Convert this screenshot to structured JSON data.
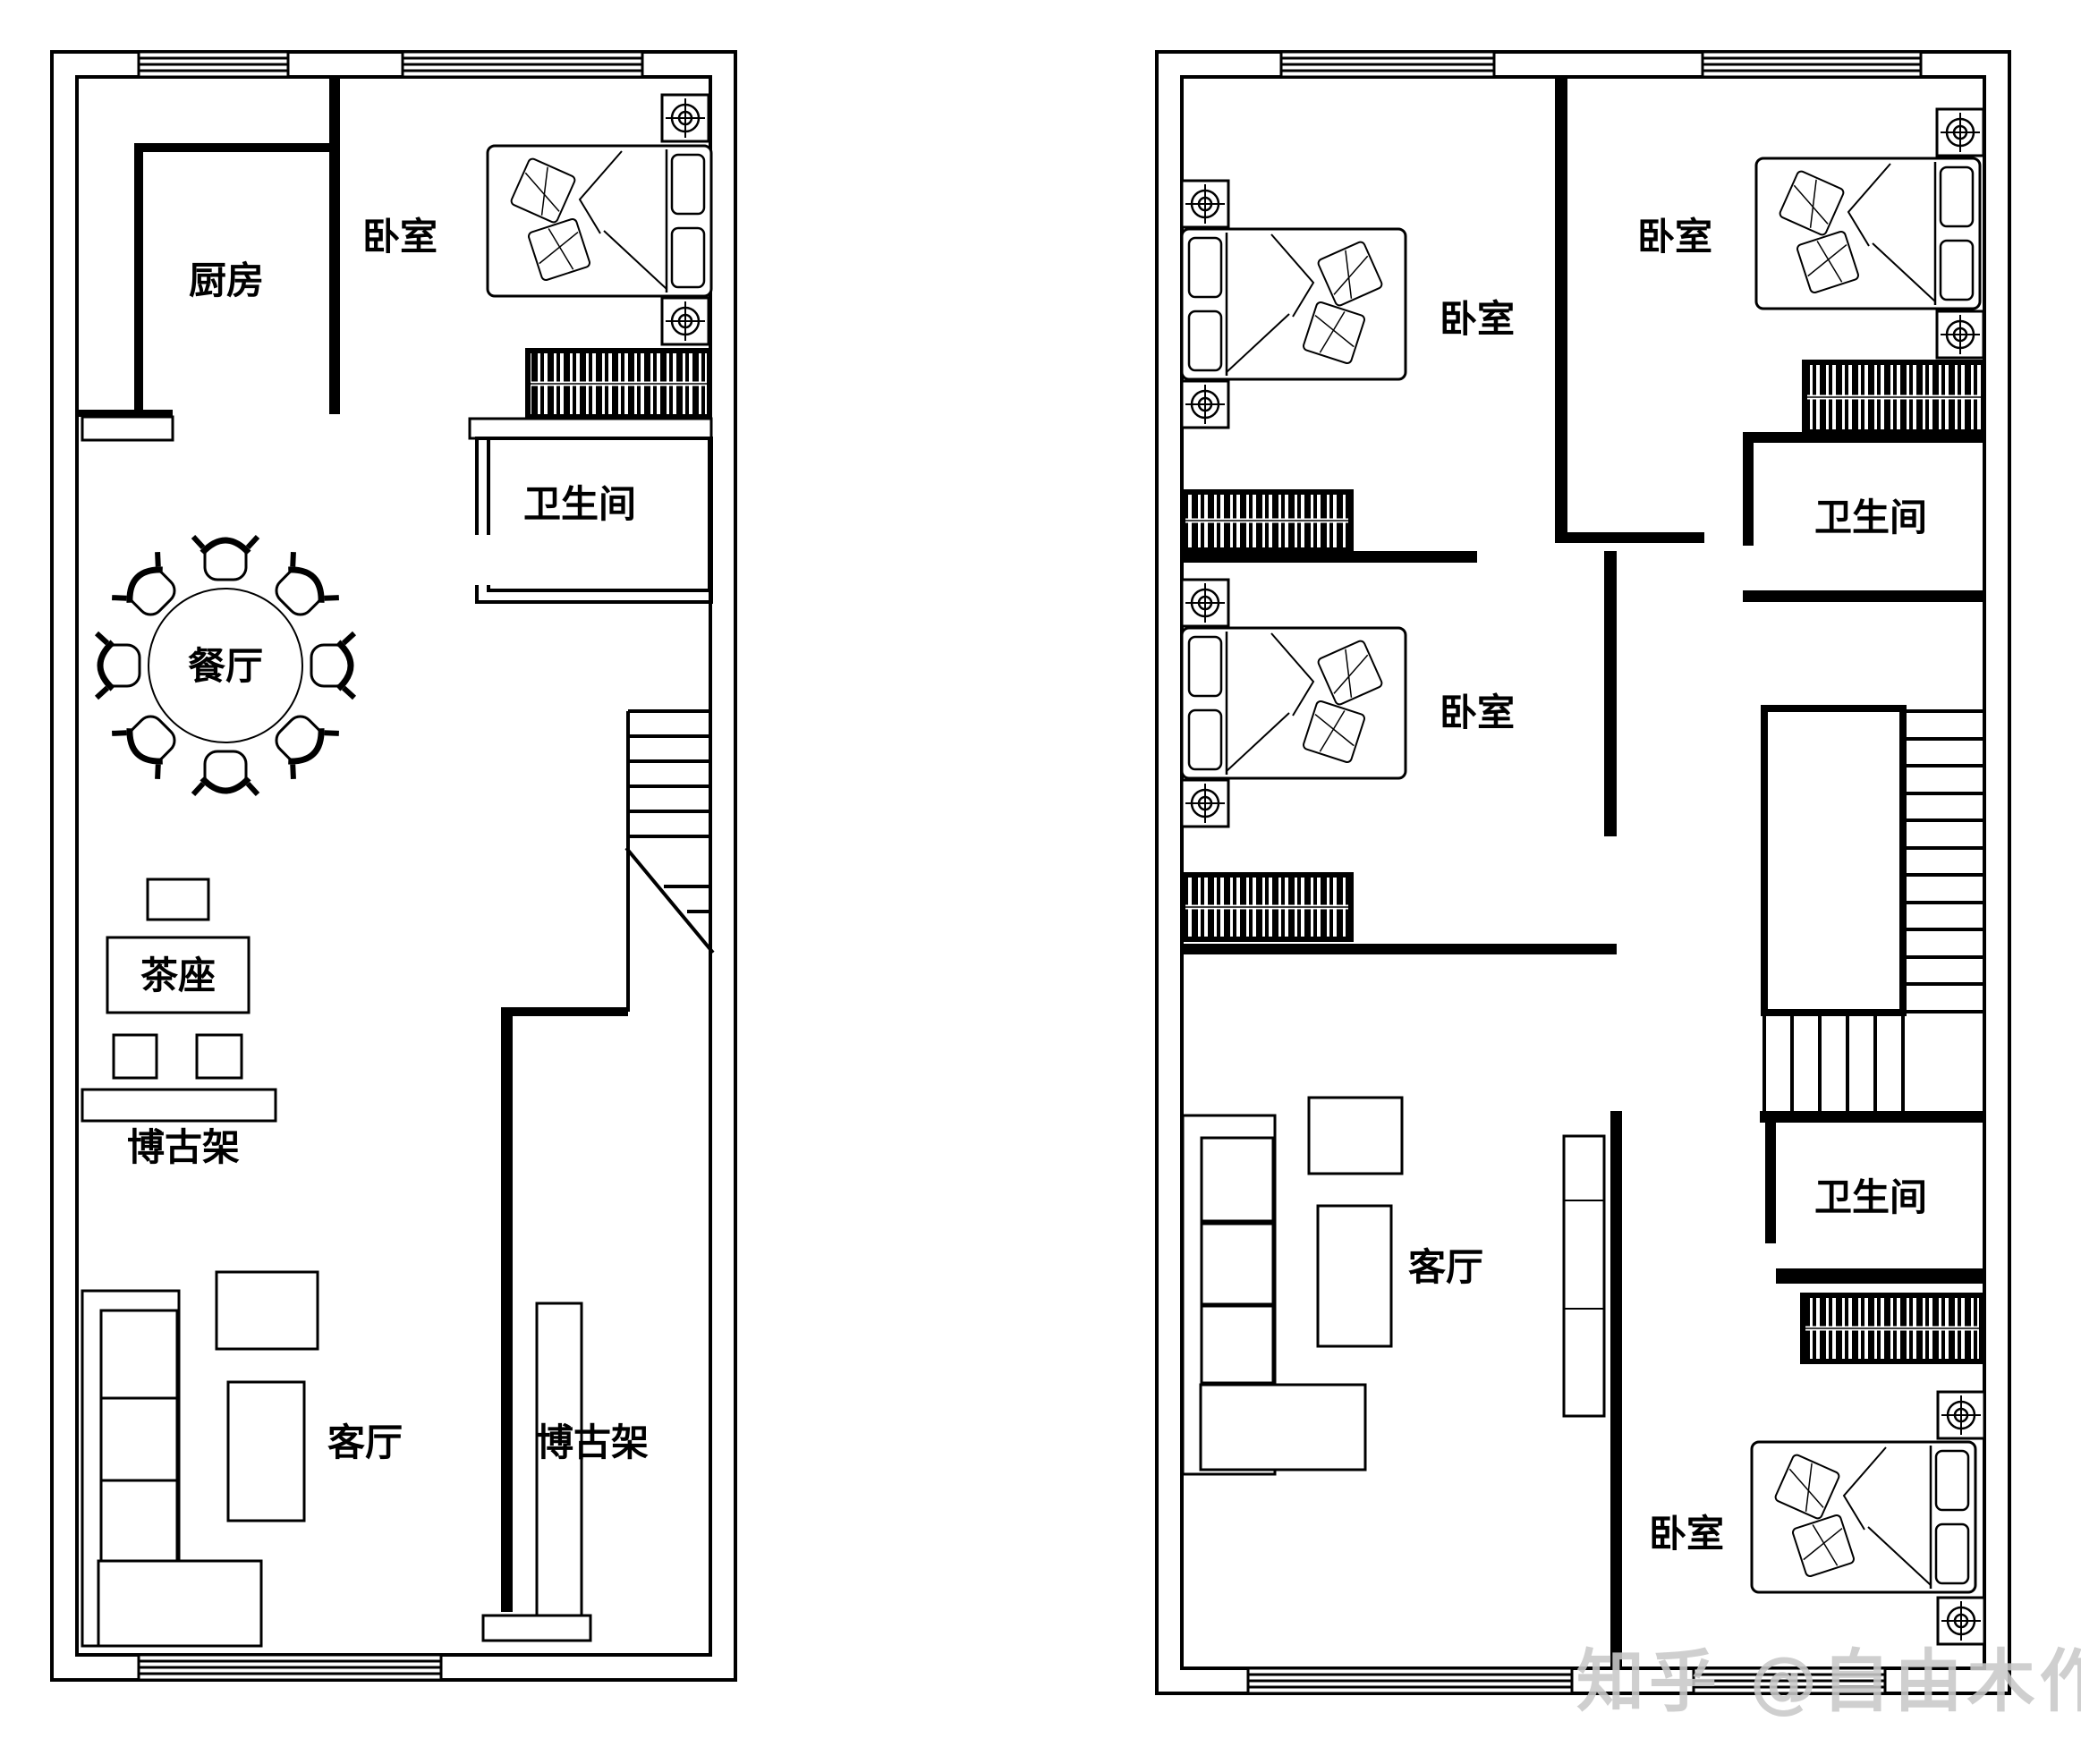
{
  "colors": {
    "line": "#000000",
    "background": "#ffffff",
    "watermark": "#c9c9c9"
  },
  "watermark": {
    "text": "知乎 @自由木作"
  },
  "floor1": {
    "rooms": {
      "kitchen": "厨房",
      "bedroom": "卧室",
      "bathroom": "卫生间",
      "dining": "餐厅",
      "tea_seat": "茶座",
      "shelf_left": "博古架",
      "living": "客厅",
      "shelf_column": "博古架"
    }
  },
  "floor2": {
    "rooms": {
      "bedroom_top_left": "卧室",
      "bedroom_top_right": "卧室",
      "bathroom_top": "卫生间",
      "bedroom_middle": "卧室",
      "living": "客厅",
      "bathroom_bottom": "卫生间",
      "bedroom_bottom": "卧室"
    }
  }
}
